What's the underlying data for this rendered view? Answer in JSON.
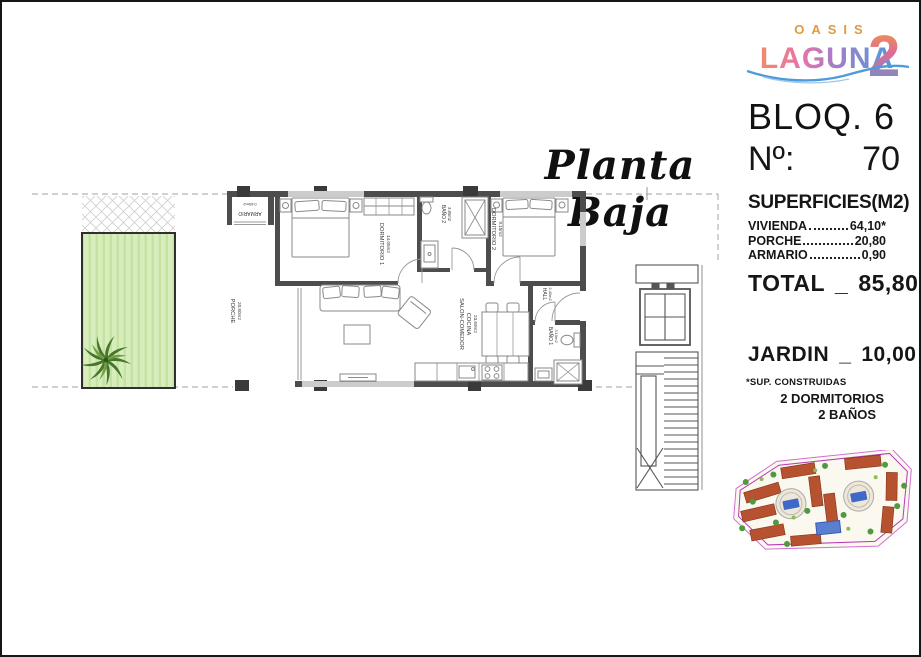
{
  "logo": {
    "oasis": "OASIS",
    "laguna": "LAGUNA",
    "two": "2"
  },
  "unit": {
    "block": "BLOQ. 6",
    "number_label": "Nº:",
    "number": "70"
  },
  "plan_title": {
    "text": "Planta Baja"
  },
  "superficies": {
    "title": "SUPERFICIES(M2)",
    "rows": [
      {
        "name": "VIVIENDA",
        "value": "64,10*"
      },
      {
        "name": "PORCHE",
        "value": "20,80"
      },
      {
        "name": "ARMARIO",
        "value": "0,90"
      }
    ],
    "total_label": "TOTAL",
    "total_sep": "_",
    "total_value": "85,80"
  },
  "jardin": {
    "label": "JARDIN",
    "sep": "_",
    "value": "10,00"
  },
  "notes": {
    "footnote": "*SUP. CONSTRUIDAS",
    "dormitorios": "2 DORMITORIOS",
    "banos": "2 BAÑOS"
  },
  "floorplan": {
    "rooms": {
      "dormitorio1": {
        "name": "DORMITORIO 1",
        "area": "14.05m2"
      },
      "dormitorio2": {
        "name": "DORMITORIO 2",
        "area": "9.15m2"
      },
      "bano1": {
        "name": "BAÑO 1",
        "area": "3.15m2"
      },
      "bano2": {
        "name": "BAÑO 2",
        "area": "3.85m2"
      },
      "hall": {
        "name": "HALL",
        "area": "2.40m2"
      },
      "salon": {
        "line1": "SALON-COMEDOR",
        "line2": "COCINA",
        "area": "23.69m2"
      },
      "porche": {
        "name": "PORCHE",
        "area": "20.80m2"
      },
      "armario": {
        "name": "ARMARIO",
        "area": "0.60m2"
      }
    }
  },
  "colors": {
    "logo_orange": "#e09a40",
    "logo_pink": "#e874a8",
    "logo_purple": "#a57cc8",
    "logo_blue": "#4f9bd9",
    "wall_gray": "#4d4d4d",
    "garden_green": "#d7eebc",
    "palm_green": "#49752c",
    "site_boundary_magenta": "#b43ab4",
    "building_red": "#b65230",
    "pool_blue": "#3f69c8"
  }
}
